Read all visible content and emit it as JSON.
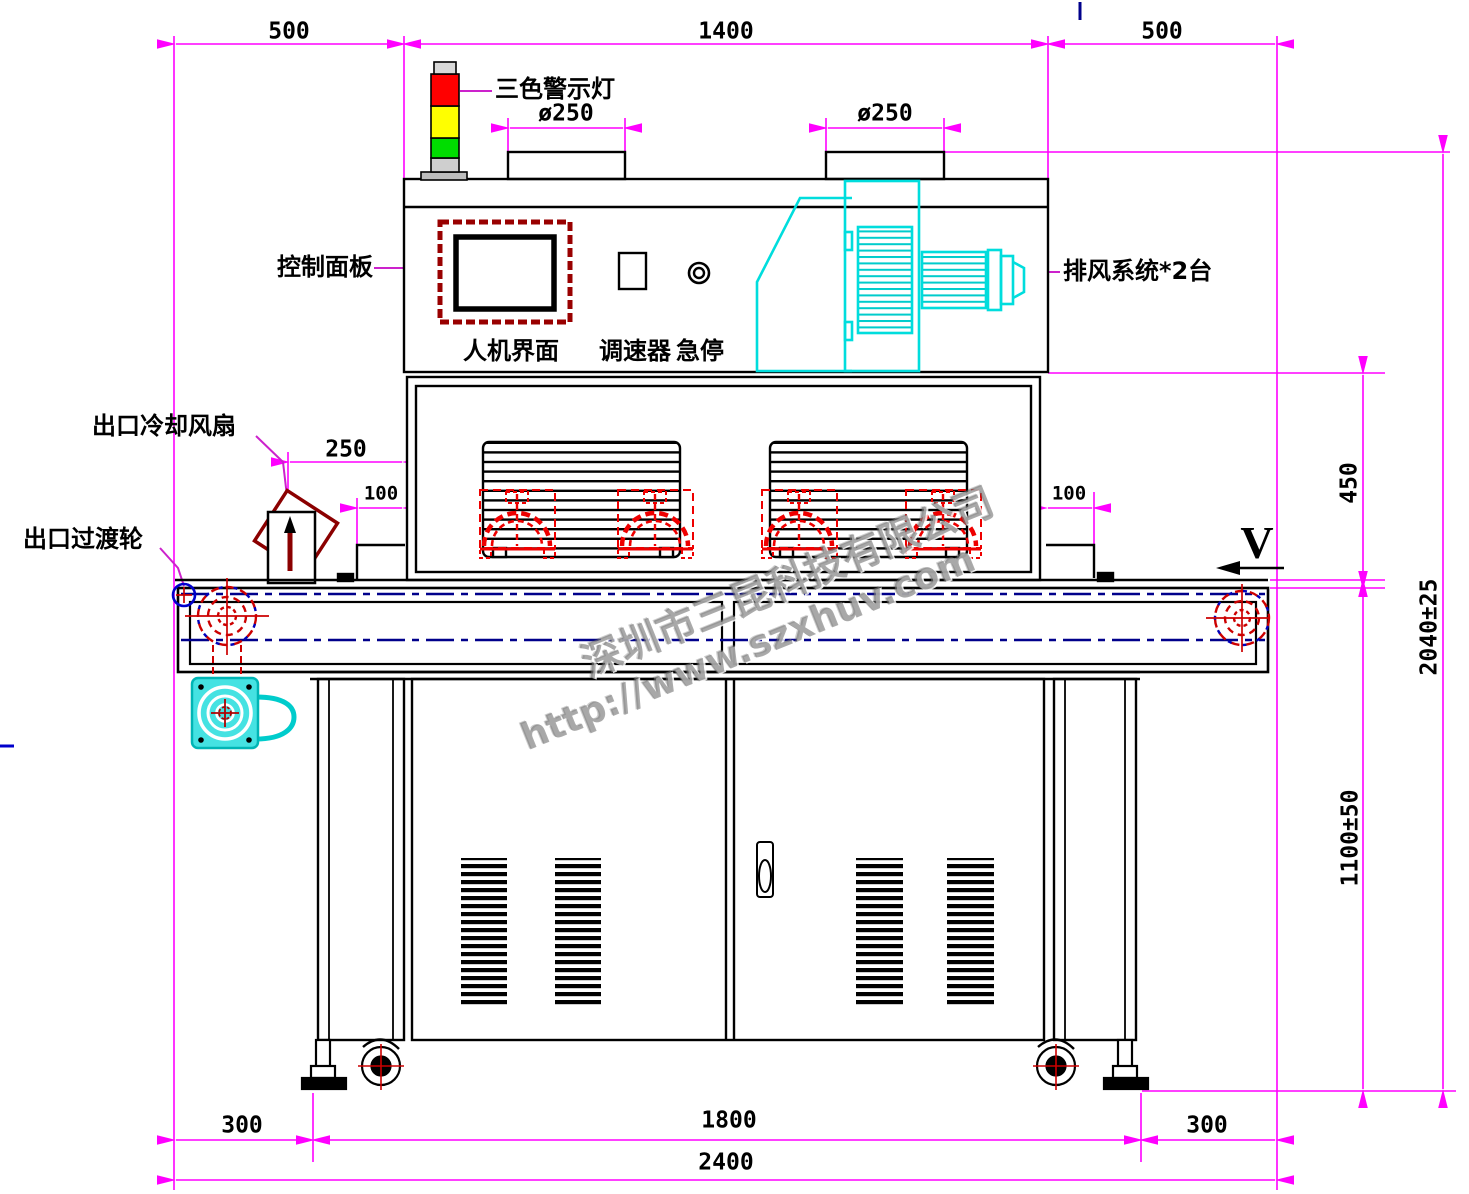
{
  "drawing": {
    "type": "engineering-front-view",
    "subject": "UV curing conveyor machine"
  },
  "labels": {
    "warning_light": "三色警示灯",
    "control_panel": "控制面板",
    "hmi": "人机界面",
    "speed_controller": "调速器",
    "emergency_stop": "急停",
    "exhaust_system": "排风系统*2台",
    "outlet_cooling_fan": "出口冷却风扇",
    "outlet_transition_wheel": "出口过渡轮",
    "conveyor_direction": "V"
  },
  "dimensions": {
    "top": {
      "left": "500",
      "center": "1400",
      "right": "500"
    },
    "duct_left": "ø250",
    "duct_right": "ø250",
    "fan_offset": "250",
    "step_left": "100",
    "step_right": "100",
    "hood_height": "450",
    "overall_height": "2040±25",
    "table_height": "1100±50",
    "bottom": {
      "left": "300",
      "center": "1800",
      "right": "300",
      "total": "2400"
    }
  },
  "watermark": {
    "company": "深圳市三昆科技有限公司",
    "url": "http://www.szxhuv.com"
  },
  "colors": {
    "dimension": "#ff00ff",
    "leader": "#cc22cc",
    "outline": "#000000",
    "exhaust_cyan": "#00dddd",
    "lamp_red": "#ee0000",
    "centerline_blue": "#00008b",
    "warn_red": "#ff0000",
    "warn_yellow": "#ffff00",
    "warn_green": "#00dd00"
  }
}
